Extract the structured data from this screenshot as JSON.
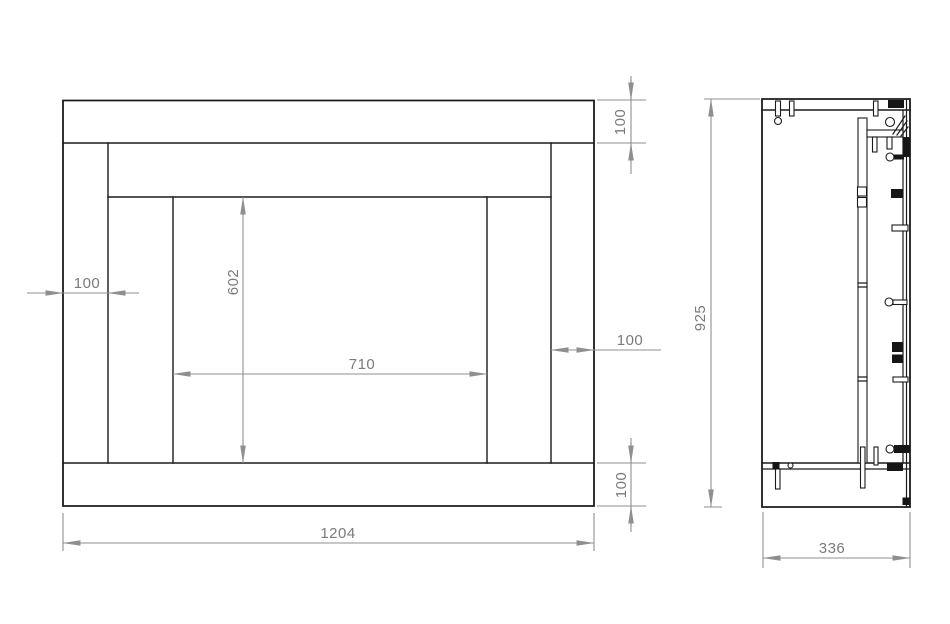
{
  "drawing": {
    "colors": {
      "object_line": "#1b1b1b",
      "dimension_line": "#8f8f8f",
      "dimension_text": "#7a7a7a",
      "background": "#ffffff"
    },
    "dimensions": {
      "front": {
        "overall_width": "1204",
        "shelf_height": "100",
        "left_leg_width": "100",
        "right_leg_width": "100",
        "plinth_height": "100",
        "opening_width": "710",
        "opening_height": "602"
      },
      "side": {
        "overall_height": "925",
        "depth": "336"
      }
    }
  }
}
